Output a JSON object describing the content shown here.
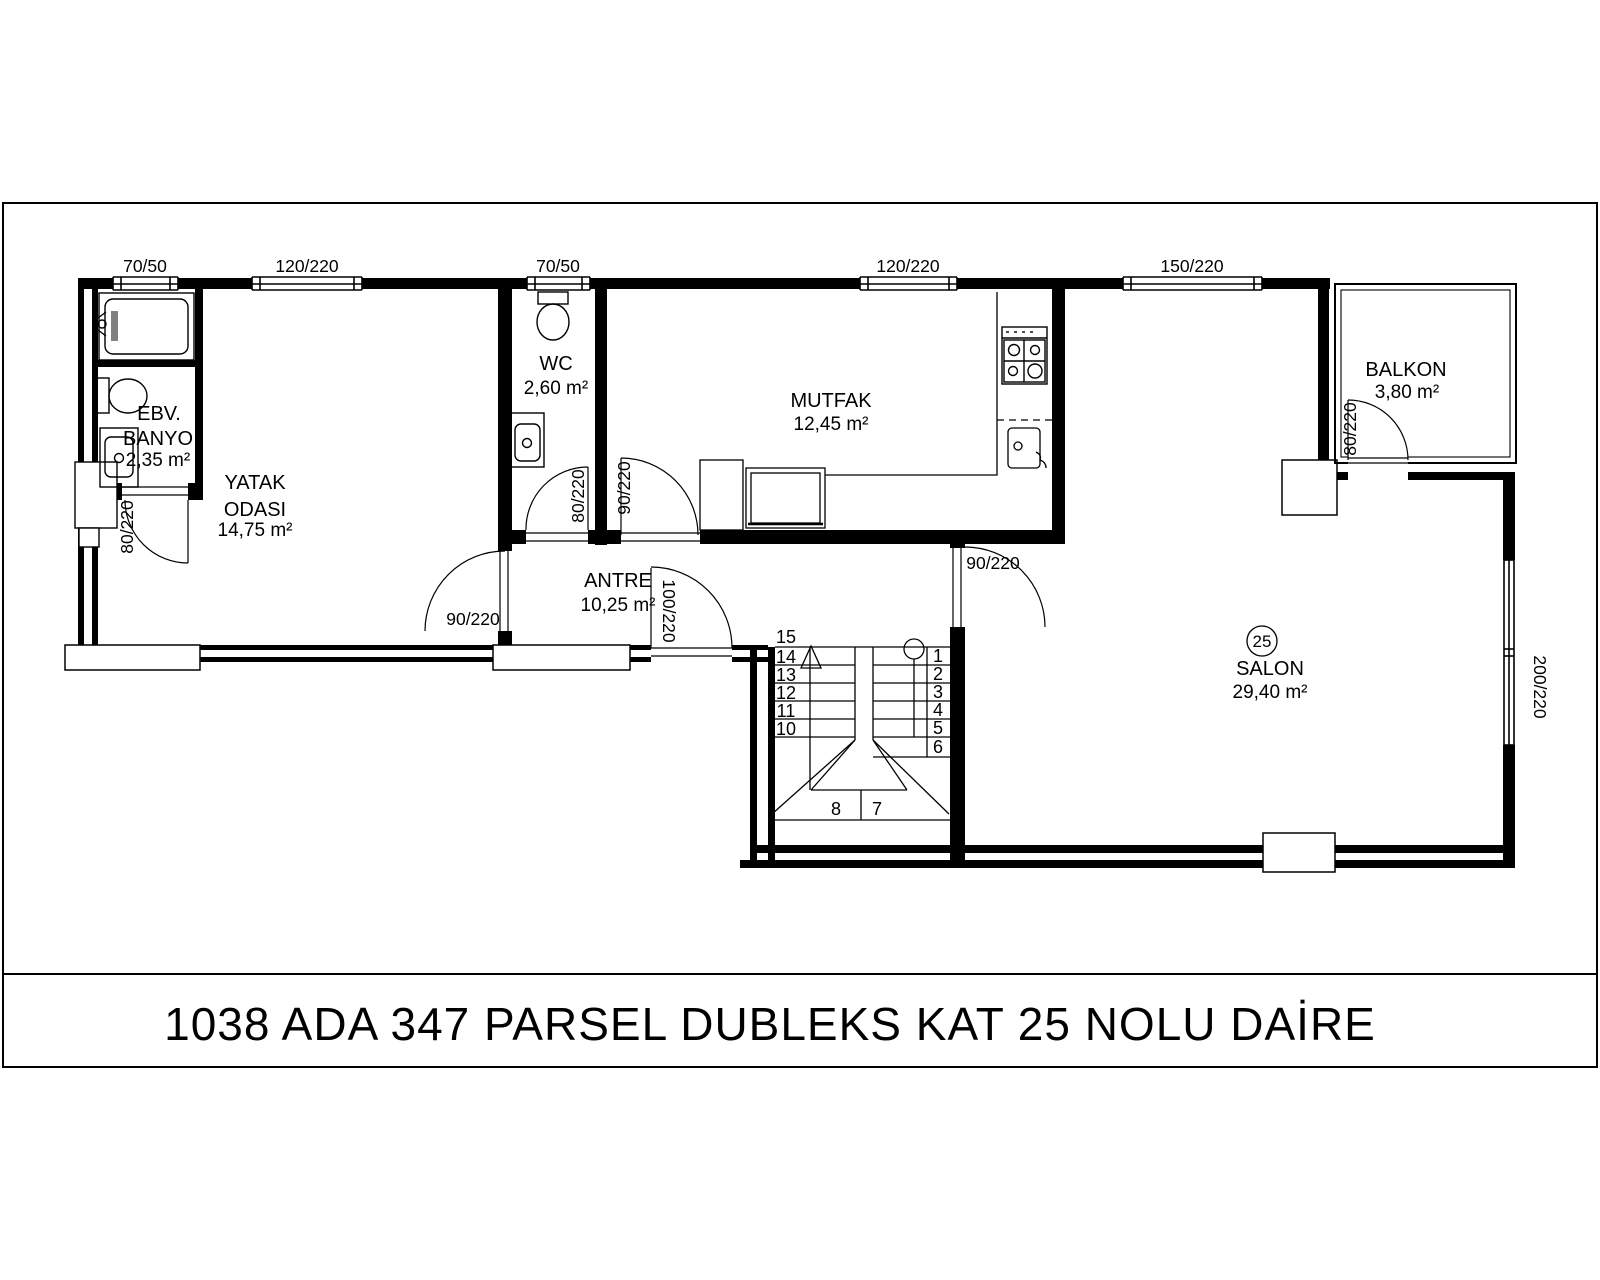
{
  "sheet": {
    "title": "1038 ADA 347 PARSEL DUBLEKS KAT 25 NOLU DAİRE"
  },
  "unit": {
    "number": "25"
  },
  "rooms": {
    "ebv_banyo": {
      "line1": "EBV.",
      "line2": "BANYO",
      "area": "2,35 m²"
    },
    "yatak_odasi": {
      "line1": "YATAK",
      "line2": "ODASI",
      "area": "14,75 m²"
    },
    "wc": {
      "name": "WC",
      "area": "2,60 m²"
    },
    "mutfak": {
      "name": "MUTFAK",
      "area": "12,45 m²"
    },
    "antre": {
      "name": "ANTRE",
      "area": "10,25 m²"
    },
    "salon": {
      "name": "SALON",
      "area": "29,40 m²"
    },
    "balkon": {
      "name": "BALKON",
      "area": "3,80 m²"
    }
  },
  "windows": {
    "w1": "70/50",
    "w2": "120/220",
    "w3": "70/50",
    "w4": "120/220",
    "w5": "150/220",
    "salon_side": "200/220"
  },
  "doors": {
    "banyo": "80/220",
    "yatak": "90/220",
    "wc": "80/220",
    "mutfak": "90/220",
    "giris": "100/220",
    "salon": "90/220",
    "balkon": "80/220"
  },
  "stairs": {
    "steps": [
      "1",
      "2",
      "3",
      "4",
      "5",
      "6",
      "7",
      "8",
      "10",
      "11",
      "12",
      "13",
      "14",
      "15"
    ]
  },
  "colors": {
    "line": "#000000",
    "paper": "#ffffff",
    "shower_gray": "#808080"
  }
}
